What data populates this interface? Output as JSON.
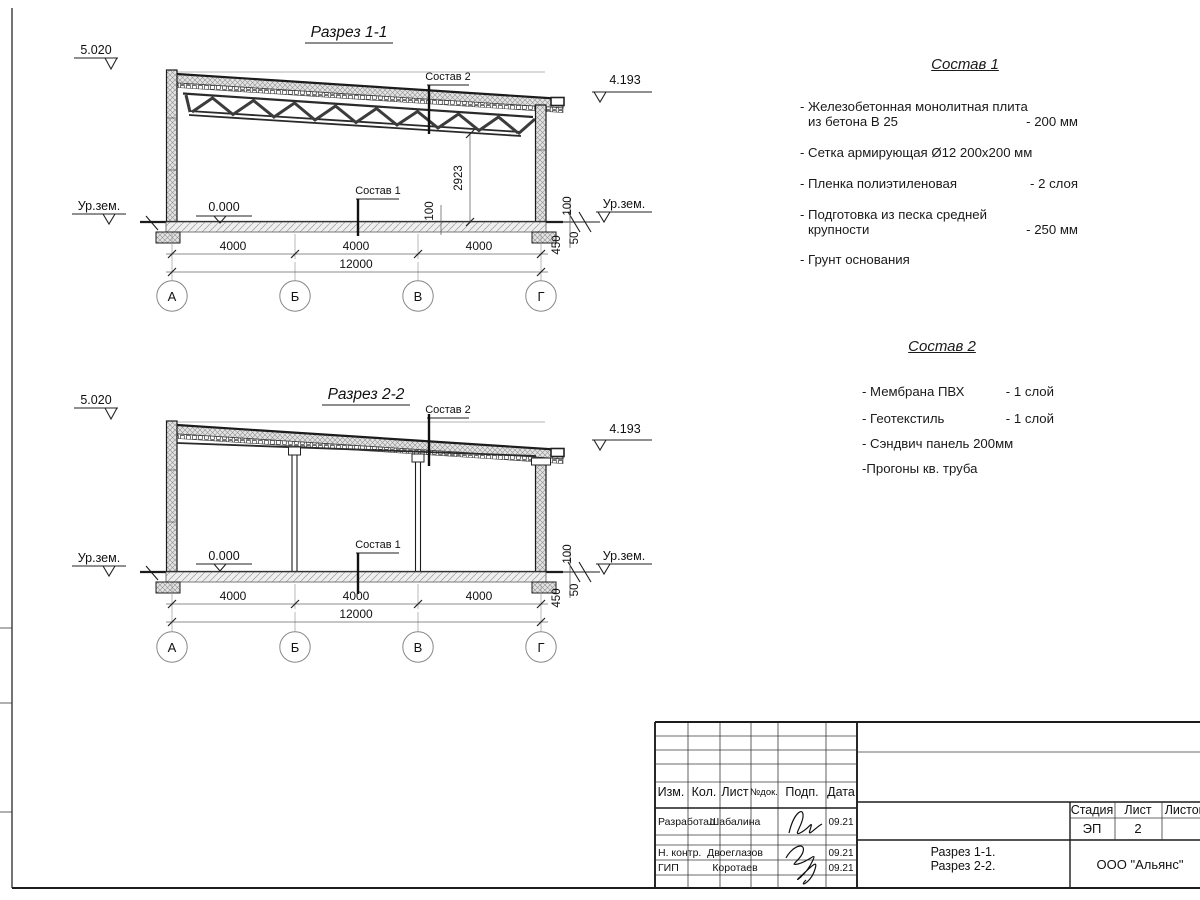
{
  "sections": [
    {
      "title": "Разрез 1-1",
      "elev_top": "5.020",
      "elev_roof": "4.193",
      "zero": "0.000",
      "ground_left": "Ур.зем.",
      "ground_right": "Ур.зем.",
      "callout_roof": "Состав 2",
      "callout_floor": "Состав 1",
      "dim_height": "2923",
      "dim_inner_100": "100",
      "dim_right_100": "100",
      "dim_450": "450",
      "dim_50": "50",
      "span_dims": [
        "4000",
        "4000",
        "4000"
      ],
      "total_dim": "12000",
      "axes": [
        "А",
        "Б",
        "В",
        "Г"
      ]
    },
    {
      "title": "Разрез 2-2",
      "elev_top": "5.020",
      "elev_roof": "4.193",
      "zero": "0.000",
      "ground_left": "Ур.зем.",
      "ground_right": "Ур.зем.",
      "callout_roof": "Состав 2",
      "callout_floor": "Состав 1",
      "dim_right_100": "100",
      "dim_450": "450",
      "dim_50": "50",
      "span_dims": [
        "4000",
        "4000",
        "4000"
      ],
      "total_dim": "12000",
      "axes": [
        "А",
        "Б",
        "В",
        "Г"
      ]
    }
  ],
  "notes1": {
    "title": "Состав 1",
    "lines": [
      {
        "text": "- Железобетонная  монолитная плита",
        "value": ""
      },
      {
        "text": "из бетона В 25",
        "value": "- 200 мм"
      },
      {
        "text": "- Сетка армирующая Ø12 200х200 мм",
        "value": ""
      },
      {
        "text": "- Пленка полиэтиленовая",
        "value": "-  2 слоя"
      },
      {
        "text": "- Подготовка из песка средней",
        "value": ""
      },
      {
        "text": "крупности",
        "value": "- 250 мм"
      },
      {
        "text": "- Грунт основания",
        "value": ""
      }
    ]
  },
  "notes2": {
    "title": "Состав 2",
    "lines": [
      {
        "text": "- Мембрана ПВХ",
        "value": "- 1 слой"
      },
      {
        "text": "- Геотекстиль",
        "value": "- 1 слой"
      },
      {
        "text": "- Сэндвич панель 200мм",
        "value": ""
      },
      {
        "text": "-Прогоны кв. труба",
        "value": ""
      }
    ]
  },
  "titleblock": {
    "cols": [
      "Изм.",
      "Кол.",
      "Лист",
      "№док.",
      "Подп.",
      "Дата"
    ],
    "rows": [
      {
        "role": "Разработал",
        "name": "Шабалина",
        "date": "09.21"
      },
      {
        "role": "Н. контр.",
        "name": "Двоеглазов",
        "date": "09.21"
      },
      {
        "role": "ГИП",
        "name": "Коротаев",
        "date": "09.21"
      }
    ],
    "stage_label": "Стадия",
    "sheet_label": "Лист",
    "sheets_label": "Листов",
    "stage": "ЭП",
    "sheet_no": "2",
    "doc1": "Разрез 1-1.",
    "doc2": "Разрез 2-2.",
    "company": "ООО \"Альянс\""
  }
}
